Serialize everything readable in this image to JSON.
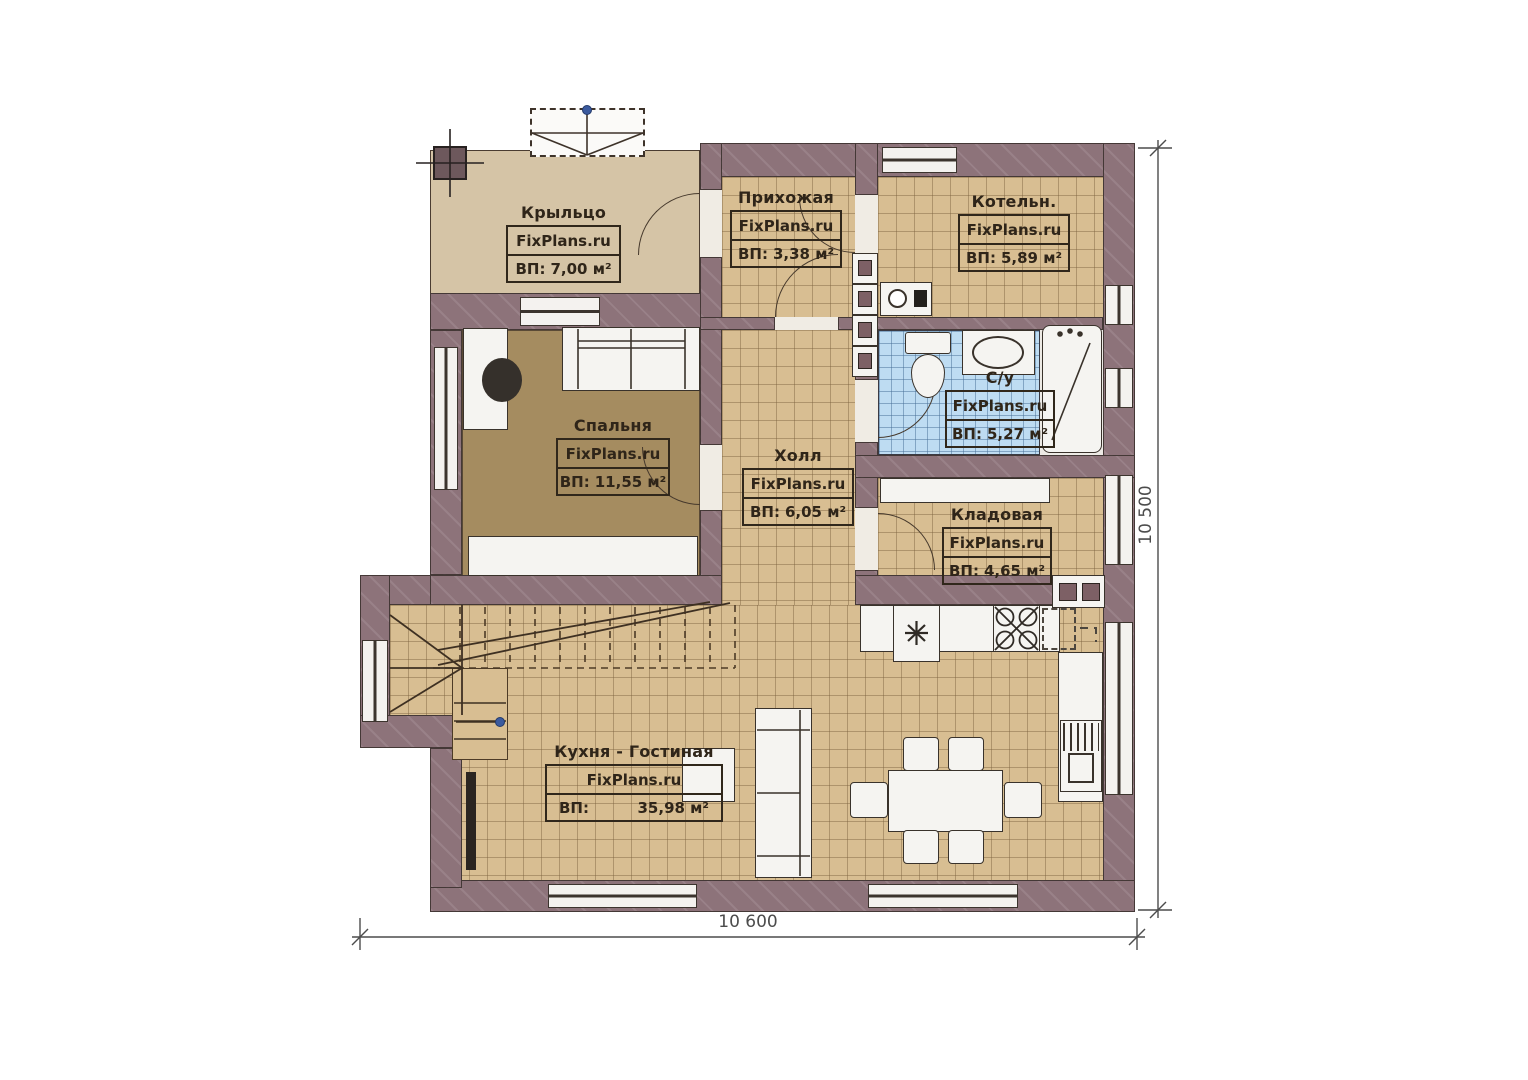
{
  "plan": {
    "rooms": [
      {
        "id": "porch",
        "name": "Крыльцо",
        "brand": "FixPlans.ru",
        "area_label": "ВП:",
        "area_value": "7,00 м²"
      },
      {
        "id": "hallway",
        "name": "Прихожая",
        "brand": "FixPlans.ru",
        "area_label": "ВП:",
        "area_value": "3,38 м²"
      },
      {
        "id": "boiler",
        "name": "Котельн.",
        "brand": "FixPlans.ru",
        "area_label": "ВП:",
        "area_value": "5,89 м²"
      },
      {
        "id": "bedroom",
        "name": "Спальня",
        "brand": "FixPlans.ru",
        "area_label": "ВП:",
        "area_value": "11,55 м²"
      },
      {
        "id": "hall",
        "name": "Холл",
        "brand": "FixPlans.ru",
        "area_label": "ВП:",
        "area_value": "6,05 м²"
      },
      {
        "id": "bathroom",
        "name": "С/у",
        "brand": "FixPlans.ru",
        "area_label": "ВП:",
        "area_value": "5,27 м²"
      },
      {
        "id": "storage",
        "name": "Кладовая",
        "brand": "FixPlans.ru",
        "area_label": "ВП:",
        "area_value": "4,65 м²"
      },
      {
        "id": "kitchen",
        "name": "Кухня - Гостиная",
        "brand": "FixPlans.ru",
        "area_label": "ВП:",
        "area_value": "35,98 м²"
      }
    ],
    "dimensions": {
      "bottom": "10 600",
      "right": "10 500"
    },
    "colors": {
      "wall": "#8d737a",
      "tile": "#d8be92",
      "porch": "#d5c4a6",
      "bedroom_floor": "#a58c60",
      "bath_tile": "#bedcf2",
      "fixture": "#f5f4f1",
      "label_text": "#2f2519",
      "dim_text": "#4c4c4c",
      "node_blue": "#3b5a9e"
    }
  }
}
